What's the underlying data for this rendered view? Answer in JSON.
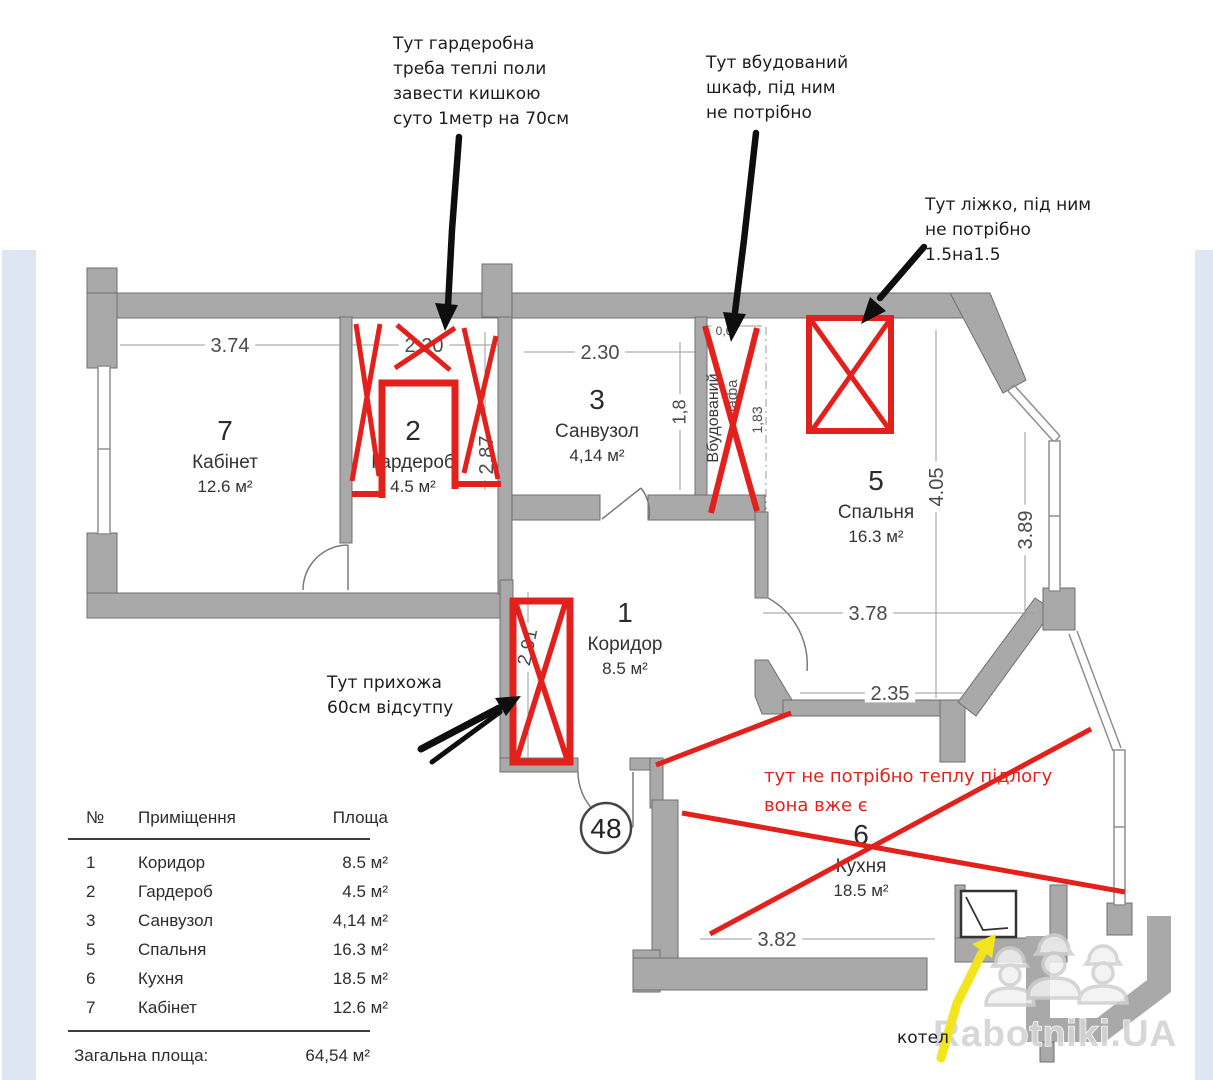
{
  "colors": {
    "wall_fill": "#a9a9a9",
    "wall_stroke": "#6f6f6f",
    "red": "#e3211c",
    "black": "#0e0e0e",
    "yellow": "#f3e51d",
    "side_strip": "#dde6f2",
    "watermark_gray": "#d4d4d4"
  },
  "notes": {
    "wardrobe": {
      "lines": [
        "Тут гардеробна",
        "треба теплі поли",
        "завести кишкою",
        "суто 1метр на 70см"
      ]
    },
    "builtin_closet": {
      "lines": [
        "Тут вбудований",
        "шкаф, під ним",
        "не потрібно"
      ]
    },
    "bed": {
      "lines": [
        "Тут ліжко, під ним",
        "не потрібно",
        "1.5на1.5"
      ]
    },
    "hallway": {
      "lines": [
        "Тут прихожа",
        "60см відсутпу"
      ]
    },
    "kitchen_heating": {
      "lines": [
        "тут не потрібно теплу підлогу",
        "вона вже є"
      ]
    },
    "boiler": "котел"
  },
  "plan": {
    "apartment_number": "48",
    "niche_label": "Вбудований",
    "niche_label2": "шафа",
    "rooms": [
      {
        "number": "7",
        "name": "Кабінет",
        "area": "12.6 м²",
        "x": 225,
        "y": 468
      },
      {
        "number": "2",
        "name": "Гардероб",
        "area": "4.5 м²",
        "x": 413,
        "y": 468
      },
      {
        "number": "3",
        "name": "Санвузол",
        "area": "4,14 м²",
        "x": 597,
        "y": 437
      },
      {
        "number": "5",
        "name": "Спальня",
        "area": "16.3 м²",
        "x": 876,
        "y": 518
      },
      {
        "number": "1",
        "name": "Коридор",
        "area": "8.5 м²",
        "x": 625,
        "y": 650
      },
      {
        "number": "6",
        "name": "Кухня",
        "area": "18.5 м²",
        "x": 861,
        "y": 872
      }
    ],
    "dimensions": [
      {
        "text": "3.74",
        "x": 230,
        "y": 345,
        "rot": 0,
        "size": 20
      },
      {
        "text": "2.20",
        "x": 424,
        "y": 345,
        "rot": 0,
        "size": 20
      },
      {
        "text": "2.30",
        "x": 600,
        "y": 352,
        "rot": 0,
        "size": 20
      },
      {
        "text": "2.87",
        "x": 486,
        "y": 455,
        "rot": -90,
        "size": 20
      },
      {
        "text": "1,8",
        "x": 679,
        "y": 412,
        "rot": -90,
        "size": 18
      },
      {
        "text": "1,83",
        "x": 757,
        "y": 420,
        "rot": -90,
        "size": 14
      },
      {
        "text": "0,6",
        "x": 724,
        "y": 331,
        "rot": 0,
        "size": 12
      },
      {
        "text": "4.05",
        "x": 936,
        "y": 487,
        "rot": -90,
        "size": 20
      },
      {
        "text": "3.89",
        "x": 1025,
        "y": 530,
        "rot": -90,
        "size": 20
      },
      {
        "text": "3.78",
        "x": 868,
        "y": 613,
        "rot": 0,
        "size": 20
      },
      {
        "text": "2.35",
        "x": 890,
        "y": 693,
        "rot": 0,
        "size": 20
      },
      {
        "text": "2.91",
        "x": 527,
        "y": 647,
        "rot": -78,
        "size": 19
      },
      {
        "text": "3.82",
        "x": 777,
        "y": 939,
        "rot": 0,
        "size": 20
      }
    ]
  },
  "table": {
    "headers": [
      "№",
      "Приміщення",
      "Площа"
    ],
    "rows": [
      [
        "1",
        "Коридор",
        "8.5 м²"
      ],
      [
        "2",
        "Гардероб",
        "4.5 м²"
      ],
      [
        "3",
        "Санвузол",
        "4,14 м²"
      ],
      [
        "5",
        "Спальня",
        "16.3 м²"
      ],
      [
        "6",
        "Кухня",
        "18.5 м²"
      ],
      [
        "7",
        "Кабінет",
        "12.6 м²"
      ]
    ],
    "total_label": "Загальна площа:",
    "total_value": "64,54 м²"
  },
  "watermark": {
    "text": "Rabotniki.UA"
  }
}
